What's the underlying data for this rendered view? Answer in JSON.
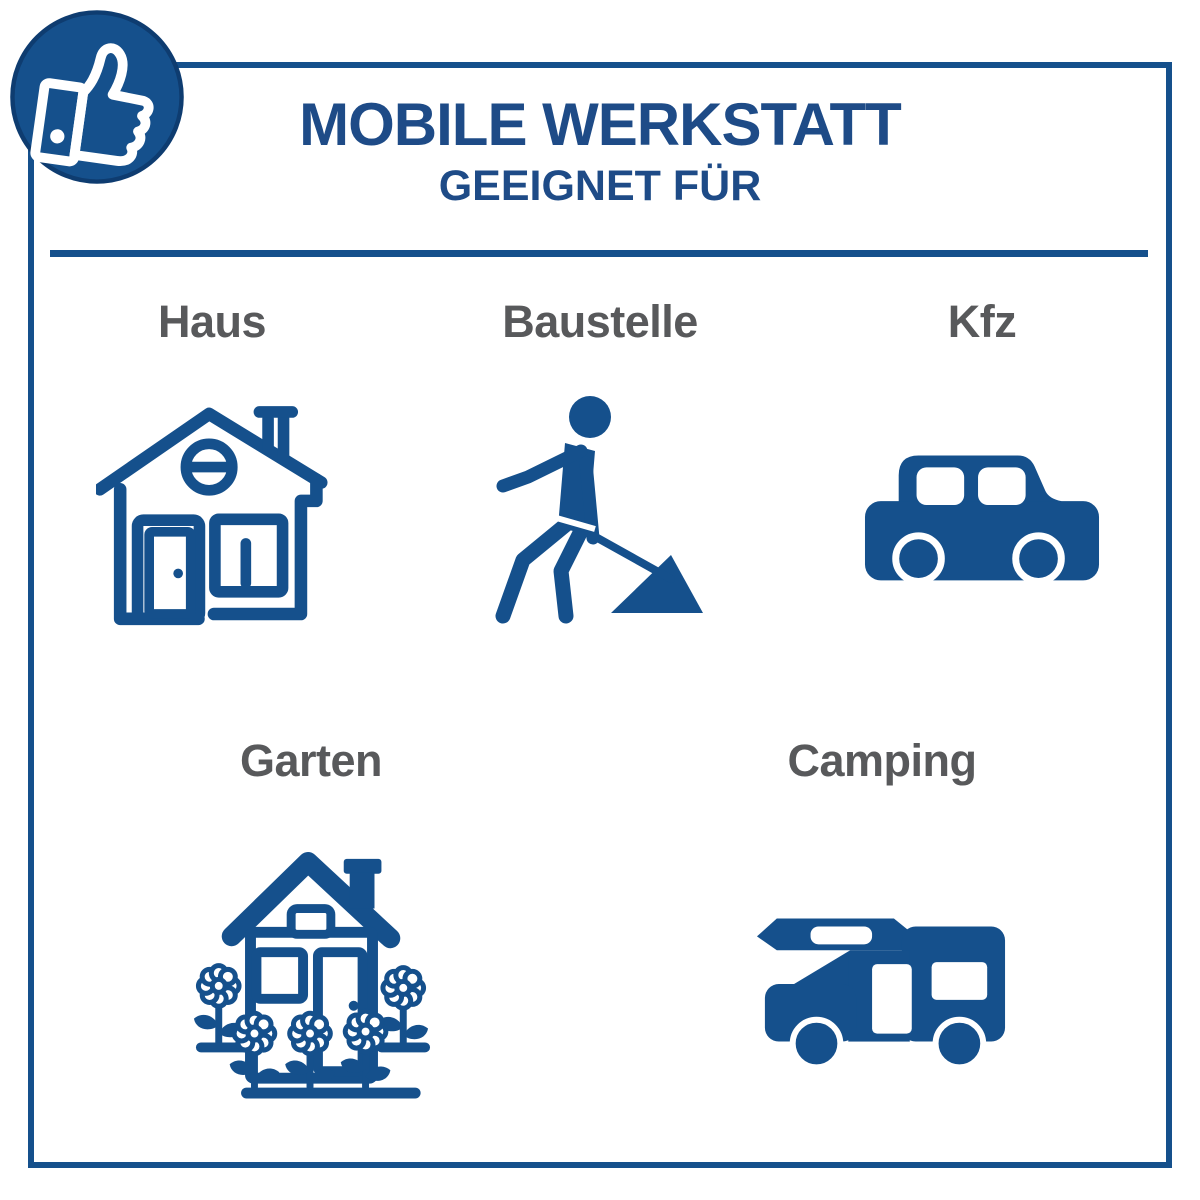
{
  "header": {
    "title": "MOBILE WERKSTATT",
    "subtitle": "GEEIGNET FÜR"
  },
  "badge": {
    "icon": "thumbs-up-icon"
  },
  "categories": [
    {
      "label": "Haus",
      "icon": "house-icon"
    },
    {
      "label": "Baustelle",
      "icon": "construction-worker-icon"
    },
    {
      "label": "Kfz",
      "icon": "car-icon"
    },
    {
      "label": "Garten",
      "icon": "garden-house-icon"
    },
    {
      "label": "Camping",
      "icon": "camper-van-icon"
    }
  ],
  "colors": {
    "accent_blue": "#15508C",
    "title_blue": "#1E4B87",
    "label_gray": "#58595B",
    "border_blue": "#15508C",
    "background": "#FFFFFF"
  }
}
